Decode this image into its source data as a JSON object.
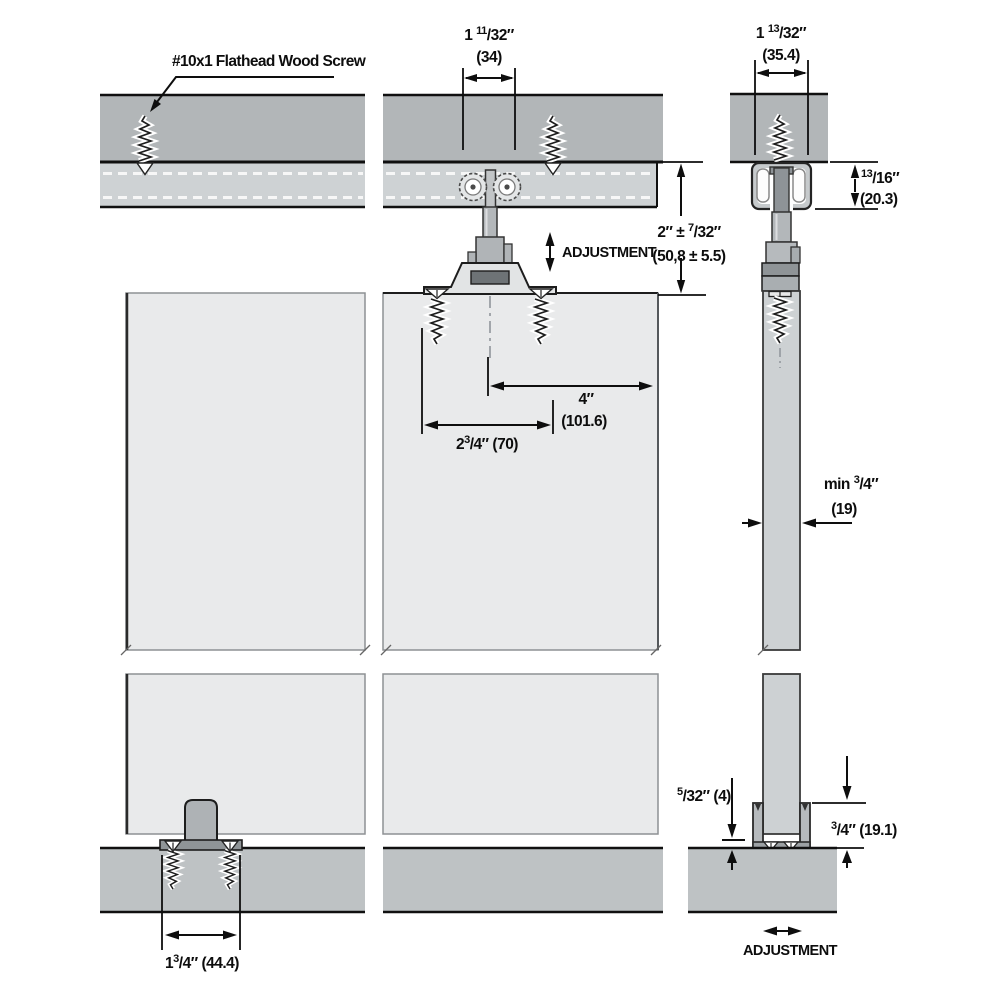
{
  "labels": {
    "screw_callout": "#10x1 Flathead Wood Screw",
    "adjustment_top": "ADJUSTMENT",
    "adjustment_bottom": "ADJUSTMENT"
  },
  "dims": {
    "track_width_front": {
      "pre": "1 ",
      "sup": "11",
      "rest": "/32″",
      "metric": "(34)"
    },
    "track_width_side": {
      "pre": "1 ",
      "sup": "13",
      "rest": "/32″",
      "metric": "(35.4)"
    },
    "track_height": {
      "pre": "",
      "sup": "13",
      "rest": "/16″",
      "metric": "(20.3)"
    },
    "hanger_drop": {
      "pre": "2″ ± ",
      "sup": "7",
      "rest": "/32″",
      "metric": "(50,8 ± 5.5)"
    },
    "edge_distance": {
      "pre": "4″",
      "sup": "",
      "rest": "",
      "metric": "(101.6)"
    },
    "plate_length": {
      "pre": "2",
      "sup": "3",
      "rest": "/4″ (70)"
    },
    "door_thickness": {
      "pre": "min ",
      "sup": "3",
      "rest": "/4″",
      "metric": "(19)"
    },
    "bottom_gap": {
      "pre": "",
      "sup": "5",
      "rest": "/32″ (4)"
    },
    "guide_height": {
      "pre": "",
      "sup": "3",
      "rest": "/4″ (19.1)"
    },
    "guide_length": {
      "pre": "1",
      "sup": "3",
      "rest": "/4″ (44.4)"
    }
  },
  "colors": {
    "header_fill": "#b2b6b8",
    "track_fill": "#ced2d4",
    "door_front_fill": "#e9eaeb",
    "door_side_fill": "#cdd1d3",
    "floor_fill": "#bec2c4",
    "hardware_fill": "#b0b4b7",
    "hardware_dark": "#6e7376",
    "line": "#0e0e0e"
  }
}
